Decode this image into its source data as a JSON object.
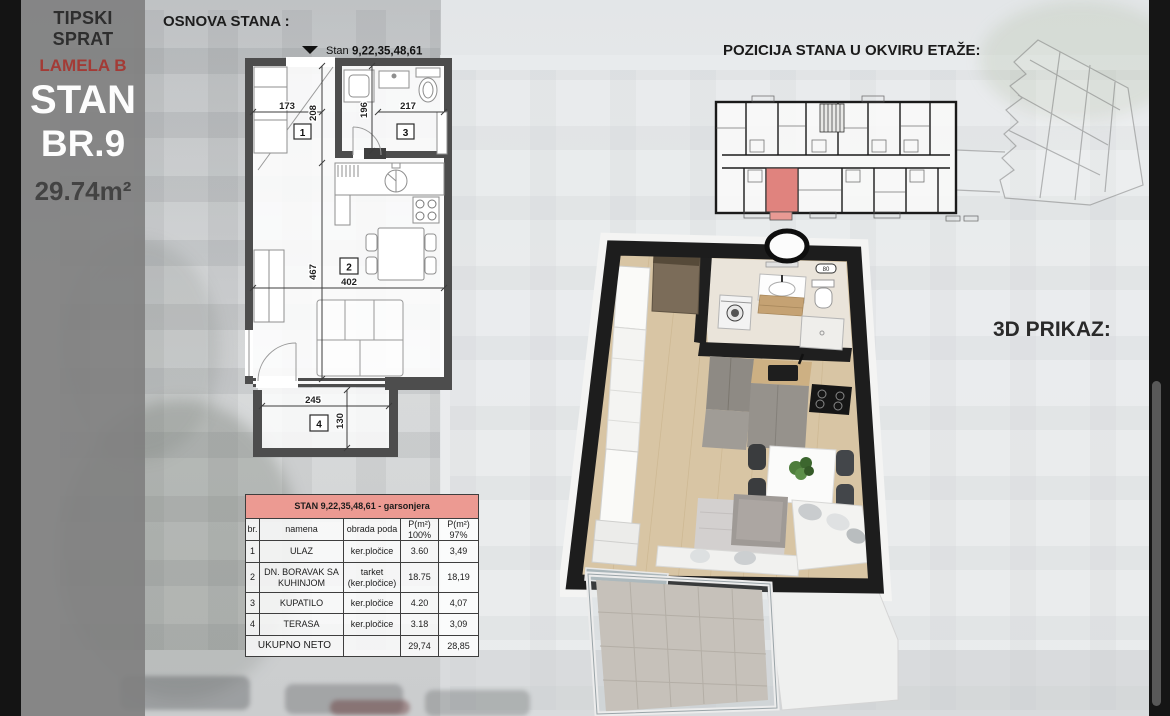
{
  "sidebar": {
    "floor_type": "TIPSKI SPRAT",
    "lamela": "LAMELA B",
    "stan": "STAN",
    "number": "BR.9",
    "area": "29.74m²"
  },
  "plan": {
    "section_title": "OSNOVA STANA :",
    "label_prefix": "Stan",
    "label_numbers": "9,22,35,48,61",
    "dims": {
      "entry_width": "173",
      "entry_depth": "208",
      "bath_depth": "196",
      "bath_width": "217",
      "living_depth": "467",
      "living_width": "402",
      "terrace_width": "245",
      "terrace_depth": "130"
    },
    "rooms": {
      "r1": "1",
      "r2": "2",
      "r3": "3",
      "r4": "4"
    }
  },
  "position": {
    "title": "POZICIJA STANA U OKVIRU ETAŽE:"
  },
  "render3d": {
    "title": "3D PRIKAZ:",
    "boiler_label": "80"
  },
  "table": {
    "title": "STAN 9,22,35,48,61 - garsonjera",
    "headers": {
      "c1": "br.",
      "c2": "namena",
      "c3": "obrada poda",
      "c4": "P(m²)\n100%",
      "c5": "P(m²)\n97%"
    },
    "rows": [
      {
        "br": "1",
        "namena": "ULAZ",
        "obrada": "ker.pločice",
        "p100": "3.60",
        "p97": "3,49"
      },
      {
        "br": "2",
        "namena": "DN. BORAVAK SA KUHINJOM",
        "obrada": "tarket\n(ker.pločice)",
        "p100": "18.75",
        "p97": "18,19"
      },
      {
        "br": "3",
        "namena": "KUPATILO",
        "obrada": "ker.pločice",
        "p100": "4.20",
        "p97": "4,07"
      },
      {
        "br": "4",
        "namena": "TERASA",
        "obrada": "ker.pločice",
        "p100": "3.18",
        "p97": "3,09"
      }
    ],
    "total_label": "UKUPNO NETO",
    "total_100": "29,74",
    "total_97": "28,85"
  },
  "colors": {
    "table_header_bg": "#ec9a92",
    "table_header_text": "#8c1f17",
    "lamela_text": "#a33b36",
    "unit_highlight": "#e0837e",
    "plan_wall": "#4d4d4d",
    "wall_3d": "#1d1d1d",
    "wood_floor": "#d8c5a4",
    "sidebar_bg": "#8a8a8a"
  }
}
